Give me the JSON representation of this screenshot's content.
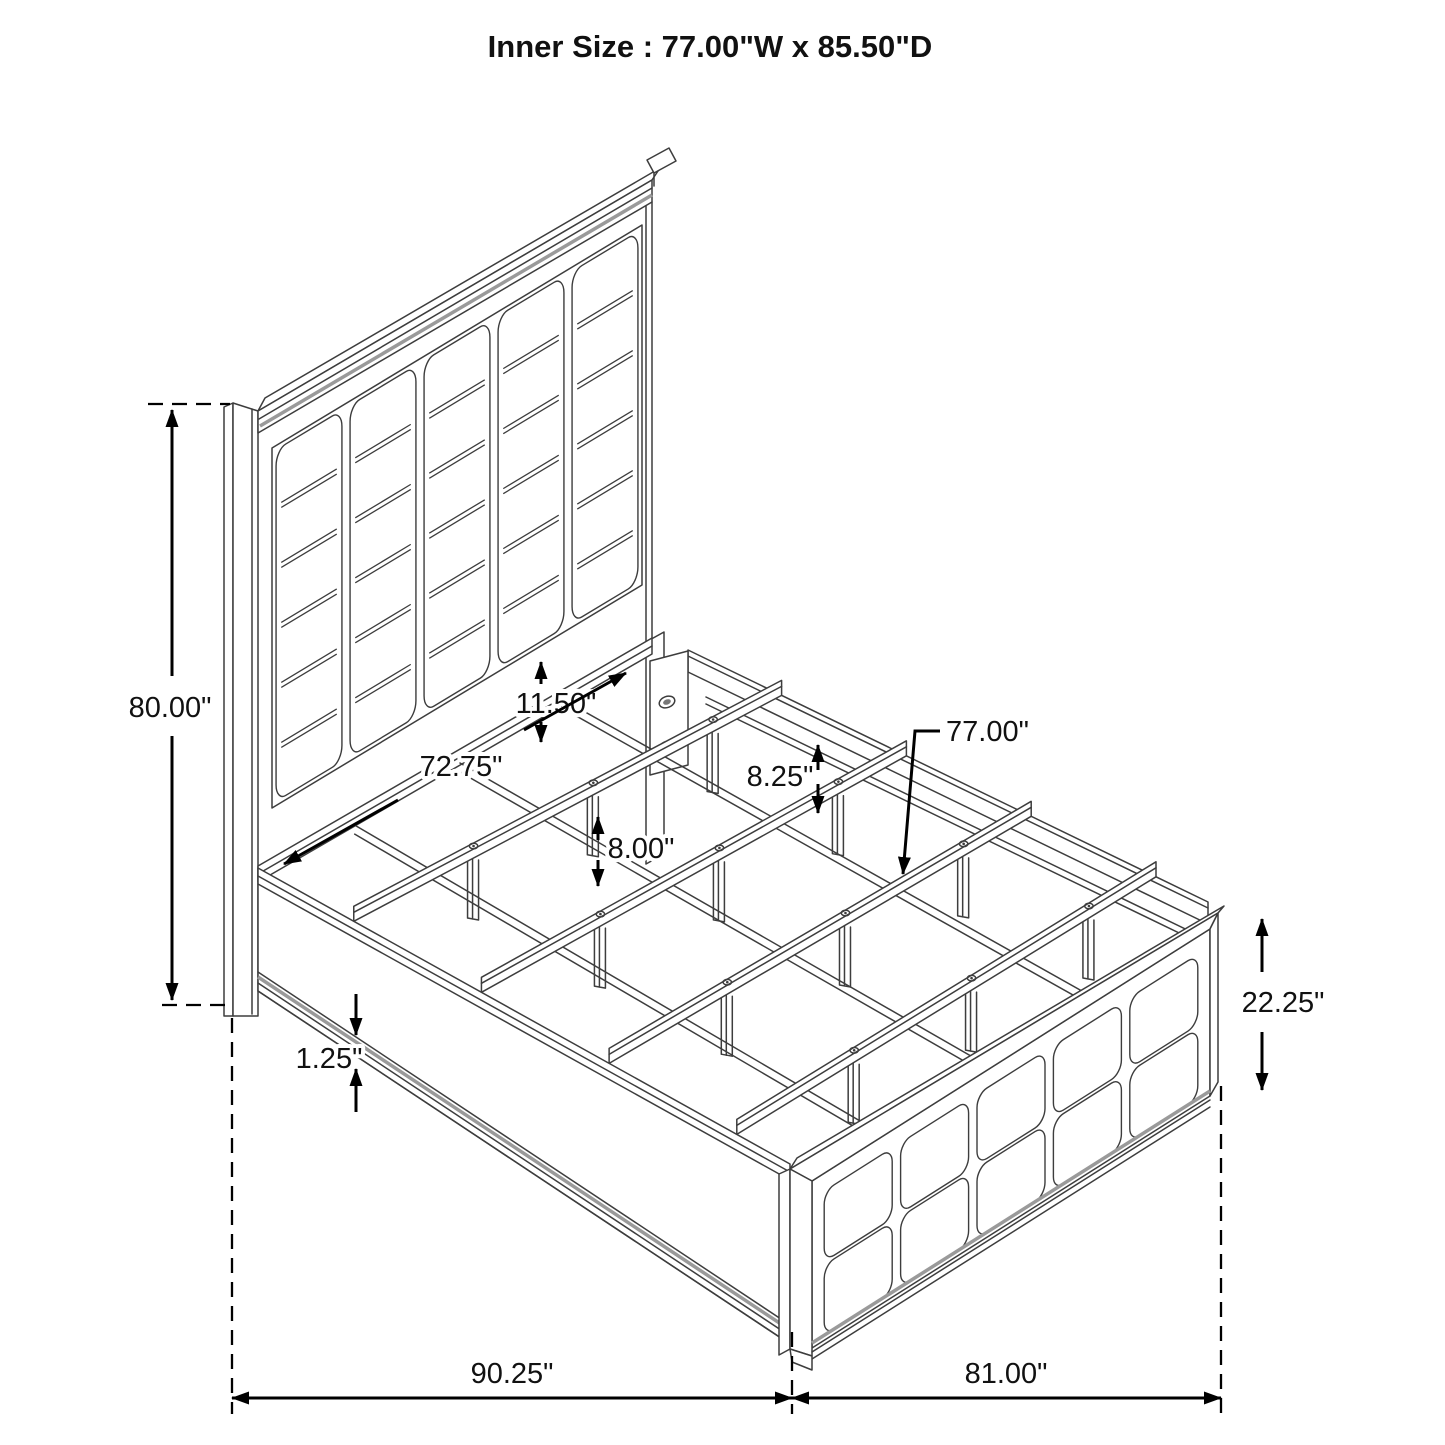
{
  "title": "Inner Size : 77.00\"W x 85.50\"D",
  "dims": {
    "headboard_height": {
      "label": "80.00\""
    },
    "panel_to_deck_gap": {
      "label": "11.50\""
    },
    "slat_span_diagonal": {
      "label": "72.75\""
    },
    "rail_to_slat": {
      "label": "8.25\""
    },
    "slat_leg_height": {
      "label": "8.00\""
    },
    "slat_length": {
      "label": "77.00\""
    },
    "footboard_height": {
      "label": "22.25\""
    },
    "base_plinth": {
      "label": "1.25\""
    },
    "overall_length": {
      "label": "90.25\""
    },
    "overall_width": {
      "label": "81.00\""
    }
  },
  "colors": {
    "background": "#ffffff",
    "linework": "#3d3d3d",
    "dimension": "#000000"
  }
}
